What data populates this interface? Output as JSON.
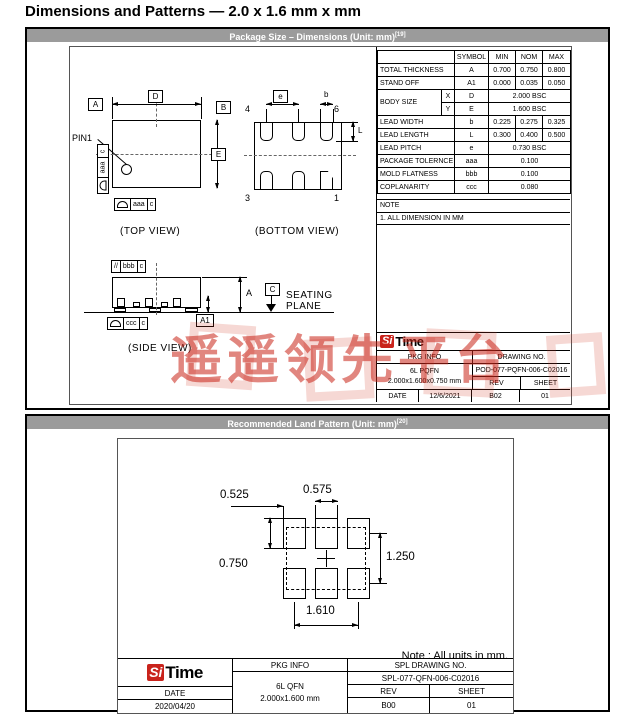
{
  "page_title": "Dimensions and Patterns — 2.0 x 1.6 mm x mm",
  "brand": {
    "si": "Si",
    "time": "Time"
  },
  "watermark": {
    "text": "遥遥领先平台",
    "color": "#c9231c"
  },
  "package_drawing": {
    "header": "Package Size – Dimensions (Unit: mm)",
    "header_sup": "[19]",
    "top_view": {
      "caption": "(TOP VIEW)",
      "pin1_label": "PIN1",
      "datum_a": "A",
      "datum_b": "B",
      "dim_d": "D",
      "dim_e": "E",
      "gdt_aaa": "aaa",
      "gdt_c": "c"
    },
    "bottom_view": {
      "caption": "(BOTTOM VIEW)",
      "dim_e": "e",
      "dim_b": "b",
      "dim_l": "L",
      "pin4": "4",
      "pin6": "6",
      "pin3": "3",
      "pin1": "1"
    },
    "side_view": {
      "caption": "(SIDE VIEW)",
      "gdt_parallel": "//",
      "gdt_bbb": "bbb",
      "gdt_ccc": "ccc",
      "gdt_c": "c",
      "dim_a": "A",
      "dim_a1": "A1",
      "datum_c": "C",
      "seating1": "SEATING",
      "seating2": "PLANE"
    },
    "dim_table": {
      "header": [
        "",
        "SYMBOL",
        "MIN",
        "NOM",
        "MAX"
      ],
      "rows": [
        {
          "name": "TOTAL THICKNESS",
          "symbol": "A",
          "min": "0.700",
          "nom": "0.750",
          "max": "0.800"
        },
        {
          "name": "STAND OFF",
          "symbol": "A1",
          "min": "0.000",
          "nom": "0.035",
          "max": "0.050"
        },
        {
          "name": "BODY SIZE",
          "sub": "X",
          "symbol": "D",
          "span": "2.000 BSC"
        },
        {
          "name": "BODY SIZE",
          "sub": "Y",
          "symbol": "E",
          "span": "1.600 BSC",
          "merge_name": true
        },
        {
          "name": "LEAD WIDTH",
          "symbol": "b",
          "min": "0.225",
          "nom": "0.275",
          "max": "0.325"
        },
        {
          "name": "LEAD LENGTH",
          "symbol": "L",
          "min": "0.300",
          "nom": "0.400",
          "max": "0.500"
        },
        {
          "name": "LEAD PITCH",
          "symbol": "e",
          "span": "0.730 BSC"
        },
        {
          "name": "PACKAGE TOLERNCE",
          "symbol": "aaa",
          "span": "0.100"
        },
        {
          "name": "MOLD FLATNESS",
          "symbol": "bbb",
          "span": "0.100"
        },
        {
          "name": "COPLANARITY",
          "symbol": "ccc",
          "span": "0.080"
        }
      ]
    },
    "note_title": "NOTE",
    "note_body": "1. ALL DIMENSION IN MM",
    "title_block": {
      "pkg_info_label": "PKG INFO",
      "drawing_no_label": "DRAWING NO.",
      "pkg_line1": "6L PQFN",
      "pkg_line2": "2.000x1.600x0.750 mm",
      "drawing_no": "POD-077-PQFN-006-C02016",
      "rev_label": "REV",
      "sheet_label": "SHEET",
      "date_label": "DATE",
      "date": "12/6/2021",
      "rev": "B02",
      "sheet": "01"
    }
  },
  "land_pattern": {
    "header": "Recommended Land Pattern (Unit: mm)",
    "header_sup": "[20]",
    "dims": {
      "pad_width": "0.575",
      "left_offset": "0.525",
      "pad_height": "0.750",
      "row_pitch": "1.250",
      "col_span": "1.610"
    },
    "note": "Note : All units in mm.",
    "title_block": {
      "pkg_info_label": "PKG INFO",
      "spl_label": "SPL DRAWING NO.",
      "spl_no": "SPL-077-QFN-006-C02016",
      "pkg_line1": "6L QFN",
      "pkg_line2": "2.000x1.600 mm",
      "rev_label": "REV",
      "sheet_label": "SHEET",
      "date_label": "DATE",
      "date": "2020/04/20",
      "rev": "B00",
      "sheet": "01"
    }
  }
}
